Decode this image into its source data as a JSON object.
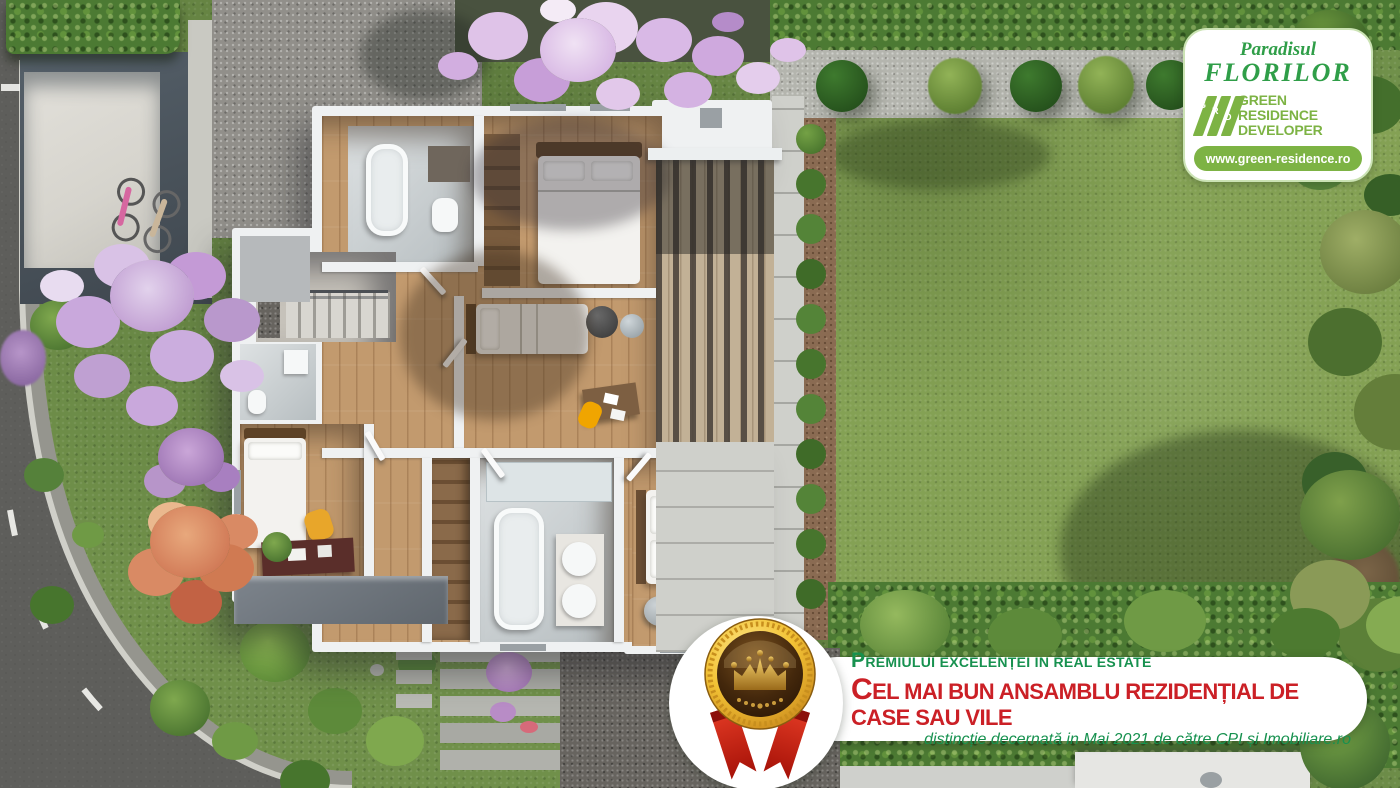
{
  "logo_badge": {
    "brand_script_line1": "Paradisul",
    "brand_script_line2": "FLORILOR",
    "grd_initials": [
      "G",
      "R",
      "D"
    ],
    "developer_line1": "GREEN RESIDENCE",
    "developer_line2": "DEVELOPER",
    "website": "www.green-residence.ro"
  },
  "award_banner": {
    "line1": "Premiului excelenței in real estate",
    "line2": "Cel mai bun ansamblu rezidențial de case sau vile",
    "line3": "distincție decernată in Mai 2021 de către CPI și Imobiliare.ro"
  },
  "colors": {
    "brand_green": "#2f9e48",
    "logo_green": "#7db344",
    "award_green": "#17914f",
    "award_red": "#cb2026",
    "medal_gold": "#f0c23c",
    "ribbon_red": "#d6281c",
    "lawn_green": "#84a154",
    "wood_floor": "#c29a6e",
    "asphalt": "#5e5e5b",
    "wall_white": "#eff1f2"
  }
}
